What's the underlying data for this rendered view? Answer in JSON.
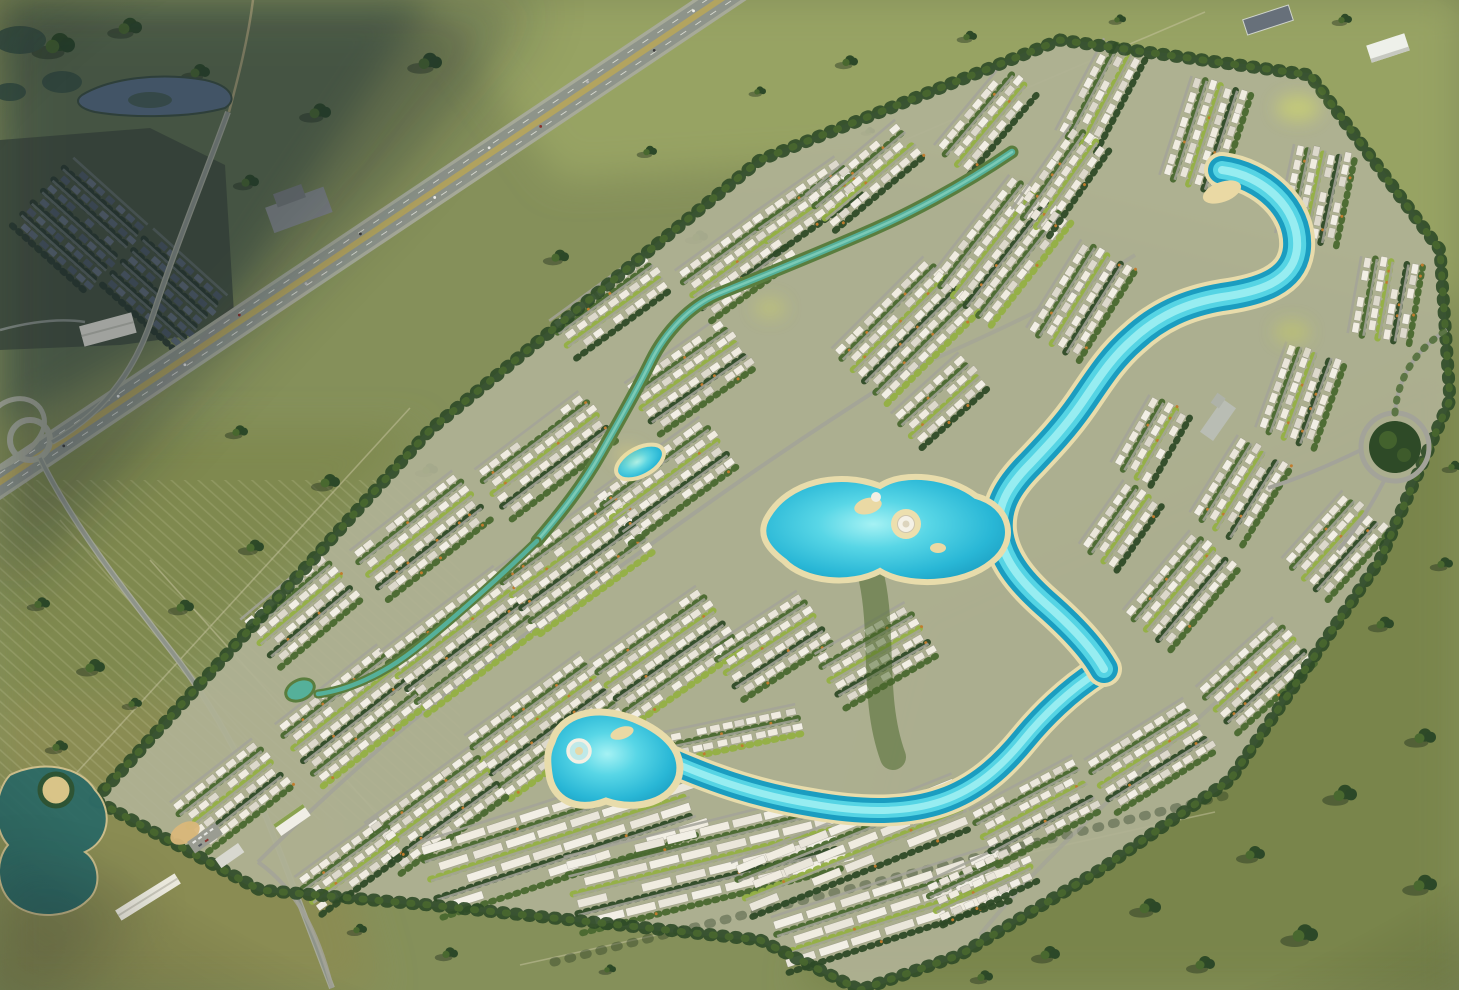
{
  "scene": {
    "description": "Sunlit aerial rendering of a large diamond-shaped lagoon villa masterplan community surrounded by open green fields, with a diagonal highway and an older shaded neighborhood at the upper left, winding turquoise crystal lagoons through white villa clusters, a central island lagoon, a beach lagoon with a shell amphitheatre, entry ponds and sales pavilions at the lower left, and a circular tree-filled roundabout park at the right.",
    "clusters": [
      [
        230,
        795,
        -38,
        4,
        8,
        "v"
      ],
      [
        350,
        715,
        -38,
        5,
        10,
        "v"
      ],
      [
        300,
        610,
        -40,
        4,
        8,
        "v"
      ],
      [
        460,
        640,
        -37,
        5,
        11,
        "v"
      ],
      [
        420,
        535,
        -38,
        4,
        10,
        "v"
      ],
      [
        575,
        560,
        -36,
        5,
        11,
        "v"
      ],
      [
        545,
        455,
        -37,
        4,
        10,
        "v"
      ],
      [
        665,
        480,
        -36,
        4,
        10,
        "v"
      ],
      [
        610,
        305,
        -36,
        3,
        9,
        "v"
      ],
      [
        690,
        375,
        -35,
        4,
        9,
        "v"
      ],
      [
        735,
        265,
        -36,
        4,
        8,
        "v"
      ],
      [
        805,
        205,
        -35,
        3,
        8,
        "v"
      ],
      [
        545,
        725,
        -36,
        5,
        11,
        "v"
      ],
      [
        665,
        655,
        -35,
        5,
        10,
        "v"
      ],
      [
        770,
        645,
        -33,
        4,
        8,
        "v"
      ],
      [
        875,
        655,
        -30,
        4,
        8,
        "v"
      ],
      [
        435,
        810,
        -36,
        4,
        10,
        "v"
      ],
      [
        350,
        865,
        -36,
        3,
        8,
        "v"
      ],
      [
        560,
        838,
        -18,
        4,
        8,
        "b"
      ],
      [
        705,
        862,
        -14,
        4,
        8,
        "b"
      ],
      [
        852,
        845,
        -22,
        3,
        7,
        "b"
      ],
      [
        893,
        908,
        -18,
        3,
        7,
        "b"
      ],
      [
        722,
        735,
        -12,
        2,
        12,
        "v"
      ],
      [
        980,
        882,
        -25,
        3,
        8,
        "v"
      ],
      [
        905,
        330,
        -45,
        5,
        10,
        "v"
      ],
      [
        1000,
        250,
        -52,
        5,
        10,
        "v"
      ],
      [
        865,
        175,
        -40,
        3,
        9,
        "v"
      ],
      [
        985,
        120,
        -50,
        3,
        8,
        "v"
      ],
      [
        1100,
        95,
        -62,
        3,
        8,
        "v"
      ],
      [
        1205,
        135,
        -72,
        4,
        8,
        "v"
      ],
      [
        1315,
        195,
        -78,
        4,
        7,
        "v"
      ],
      [
        1385,
        300,
        -80,
        4,
        6,
        "v"
      ],
      [
        1080,
        300,
        -58,
        4,
        8,
        "v"
      ],
      [
        1300,
        395,
        -70,
        4,
        7,
        "v"
      ],
      [
        1240,
        490,
        -58,
        4,
        7,
        "v"
      ],
      [
        1335,
        545,
        -48,
        4,
        7,
        "v"
      ],
      [
        1180,
        590,
        -50,
        4,
        8,
        "v"
      ],
      [
        1255,
        675,
        -42,
        4,
        8,
        "v"
      ],
      [
        1120,
        525,
        -55,
        3,
        6,
        "v"
      ],
      [
        1150,
        755,
        -32,
        4,
        9,
        "v"
      ],
      [
        1035,
        810,
        -28,
        4,
        9,
        "v"
      ],
      [
        1060,
        180,
        -55,
        3,
        8,
        "v"
      ],
      [
        1150,
        440,
        -60,
        3,
        6,
        "v"
      ],
      [
        940,
        400,
        -42,
        3,
        7,
        "v"
      ],
      [
        80,
        225,
        42,
        6,
        8,
        "d"
      ],
      [
        165,
        290,
        42,
        5,
        8,
        "d"
      ]
    ],
    "fieldTrees": [
      [
        60,
        42,
        1.5
      ],
      [
        130,
        25,
        1.2
      ],
      [
        200,
        70,
        1.0
      ],
      [
        320,
        110,
        1.1
      ],
      [
        430,
        60,
        1.2
      ],
      [
        540,
        120,
        0.8
      ],
      [
        650,
        150,
        0.7
      ],
      [
        760,
        90,
        0.6
      ],
      [
        250,
        180,
        0.9
      ],
      [
        560,
        255,
        0.9
      ],
      [
        700,
        235,
        0.8
      ],
      [
        850,
        60,
        0.8
      ],
      [
        970,
        35,
        0.7
      ],
      [
        1120,
        18,
        0.6
      ],
      [
        1345,
        18,
        0.7
      ],
      [
        330,
        480,
        1.0
      ],
      [
        430,
        468,
        0.8
      ],
      [
        255,
        545,
        0.9
      ],
      [
        185,
        605,
        0.9
      ],
      [
        95,
        665,
        1.0
      ],
      [
        240,
        430,
        0.8
      ],
      [
        60,
        745,
        0.8
      ],
      [
        135,
        702,
        0.7
      ],
      [
        42,
        602,
        0.8
      ],
      [
        450,
        952,
        0.8
      ],
      [
        360,
        928,
        0.7
      ],
      [
        610,
        968,
        0.6
      ],
      [
        1050,
        952,
        1.0
      ],
      [
        1150,
        905,
        1.1
      ],
      [
        1255,
        852,
        1.0
      ],
      [
        1345,
        792,
        1.2
      ],
      [
        1425,
        735,
        1.1
      ],
      [
        1305,
        932,
        1.3
      ],
      [
        1425,
        882,
        1.2
      ],
      [
        1385,
        622,
        0.9
      ],
      [
        1445,
        562,
        0.8
      ],
      [
        1205,
        962,
        1.0
      ],
      [
        985,
        975,
        0.8
      ],
      [
        1455,
        465,
        0.7
      ],
      [
        870,
        130,
        0.5
      ]
    ],
    "cars": [
      0.06,
      0.12,
      0.2,
      0.27,
      0.33,
      0.41,
      0.5,
      0.58,
      0.66,
      0.74,
      0.82,
      0.9
    ]
  },
  "colors": {
    "grassBase": "#85905a",
    "grassShade": "#5f7050",
    "grassLight": "#97a363",
    "grassMidLeft": "#7f894f",
    "grassBottomLeft": "#8a8c52",
    "grassBottomRight": "#79854b",
    "devGround": "#b0b295",
    "treeDark": "#2e4a27",
    "treeMid": "#49682f",
    "treeLight": "#6d8a3a",
    "palmBright": "#93b043",
    "accentTree": "#c07c2e",
    "street": "#a3a399",
    "asphalt": "#8e948a",
    "shoulder": "#a7aa99",
    "median": "#b3a45f",
    "laneLine": "#f2f2e8",
    "track": "#c9c6a2",
    "lagoonDeep": "#1b9dc0",
    "lagoonMid": "#27b5d4",
    "lagoonLight": "#55d4e4",
    "lagoonPale": "#9ff0f2",
    "sand": "#e8dcab",
    "canalGreen": "#5a7d3e",
    "canalWater": "#55b09a",
    "canalHi": "#7fcdb9",
    "pondTealDark": "#2e6b66",
    "pondSlate": "#5a7084",
    "marsh": "#3e5644",
    "villa1": "#f2efe5",
    "villa2": "#eae6da",
    "villa3": "#f0ece0",
    "villa4": "#ddd9cc",
    "darkHouse1": "#57636f",
    "darkHouse2": "#4c5863",
    "darkHouse3": "#616d78",
    "darkVeg": "#2c3b2f",
    "darkStreet": "#646e6a",
    "nbhdBase": "#46523f",
    "shadow": "#16242e"
  }
}
